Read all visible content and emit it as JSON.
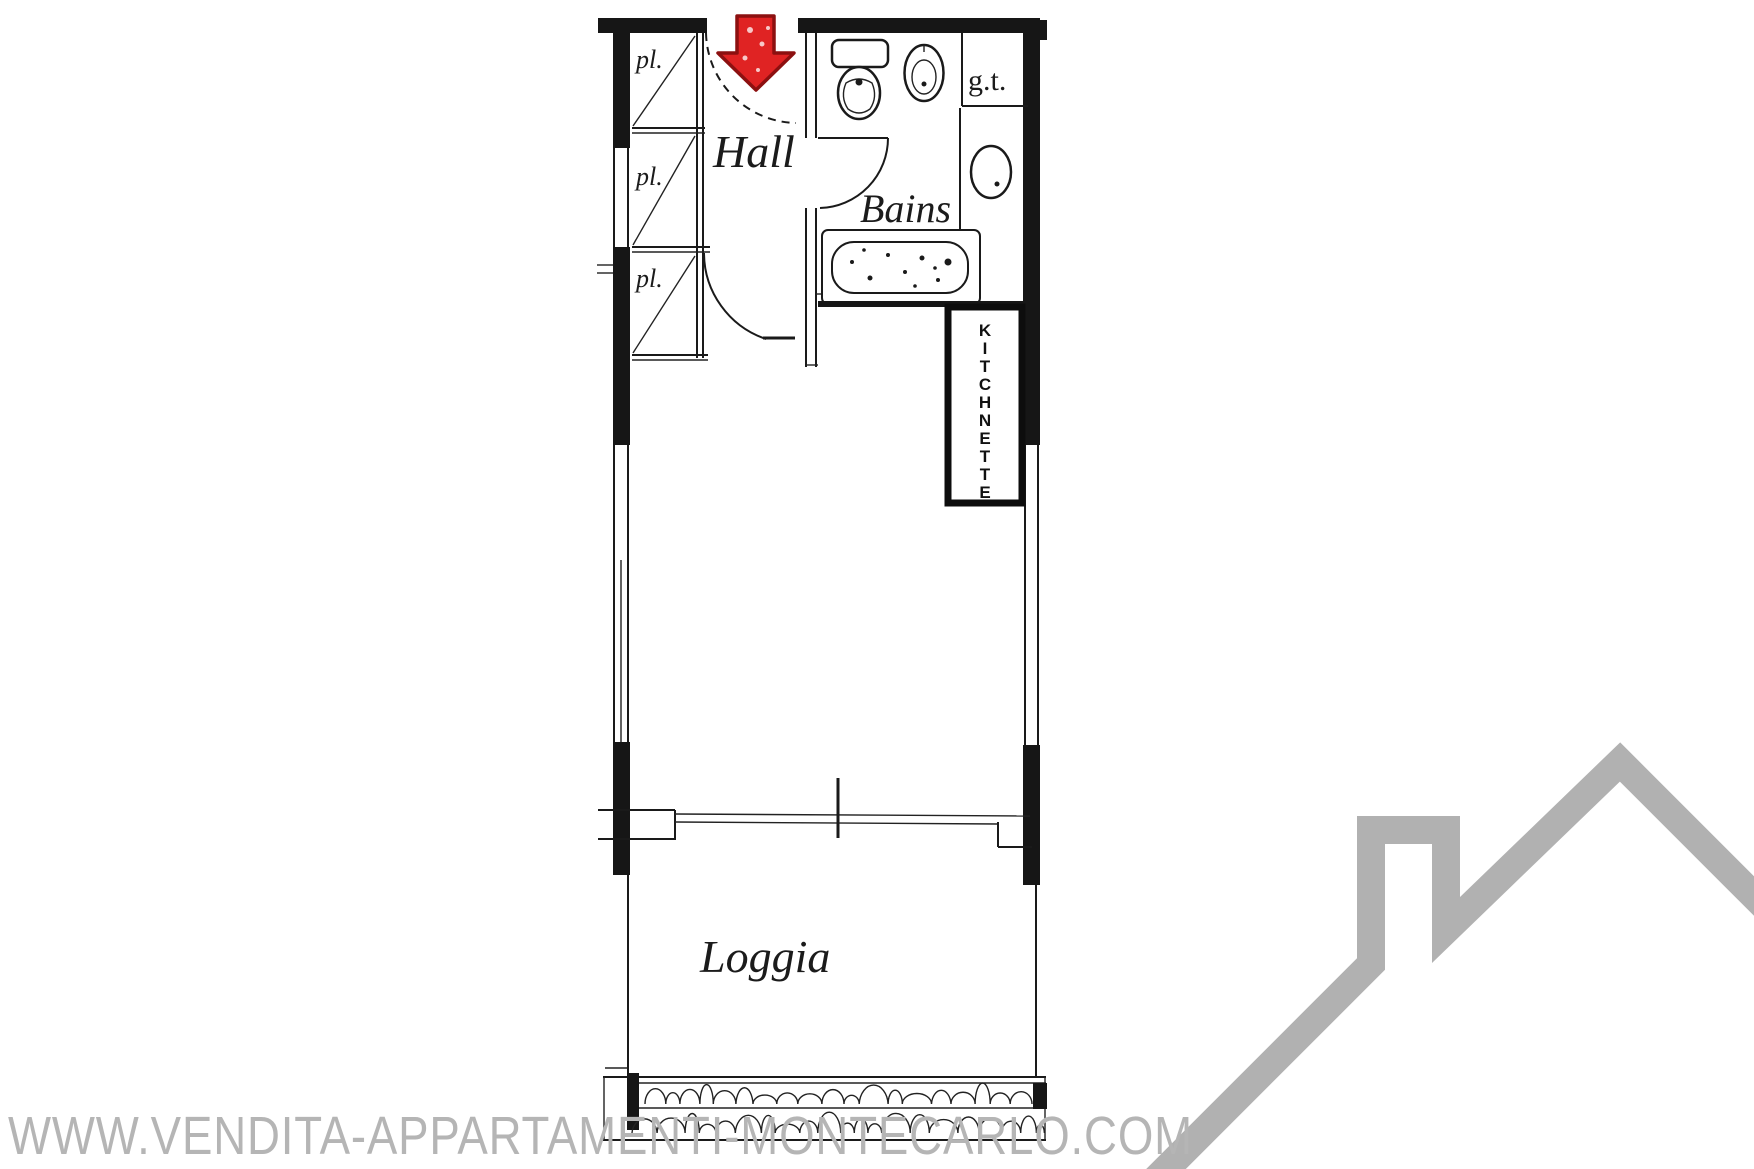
{
  "floor_plan": {
    "rooms": {
      "hall": "Hall",
      "bathroom": "Bains",
      "loggia": "Loggia",
      "technical_duct": "g.t.",
      "kitchenette_word": "KITCHNETTE",
      "kitchenette_letters": [
        "K",
        "I",
        "T",
        "C",
        "H",
        "N",
        "E",
        "T",
        "T",
        "E"
      ],
      "closets": [
        {
          "label": "pl."
        },
        {
          "label": "pl."
        },
        {
          "label": "pl."
        }
      ]
    },
    "watermark": "WWW.VENDITA-APPARTAMENTI-MONTECARLO.COM",
    "colors": {
      "plan_line": "#1a1a1a",
      "arrow_red": "#e02323",
      "arrow_red_dark": "#8c1010",
      "watermark_gray": "#b5b5b5",
      "logo_gray": "#b1b1b1"
    }
  }
}
